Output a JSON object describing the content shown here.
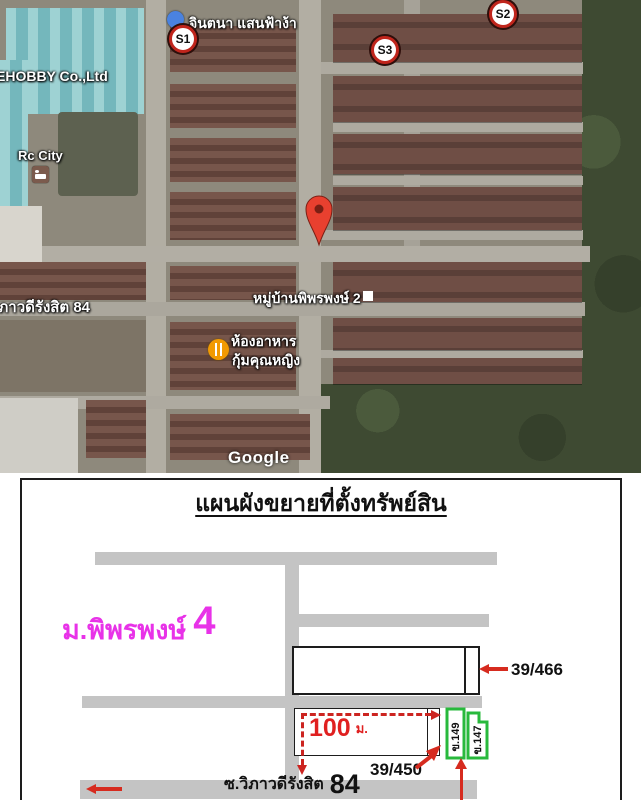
{
  "map": {
    "labels": {
      "place_top": "จินตนา แสนฟ้าง้า",
      "company": "EHOBBY Co.,Ltd",
      "rc_city": "Rc City",
      "village": "หมู่บ้านพิพรพงษ์ 2",
      "restaurant_line1": "ห้องอาหาร",
      "restaurant_line2": "กุ้มคุณหญิง",
      "road": "วิภาวดีรังสิต 84",
      "watermark": "Google"
    },
    "markers": {
      "s1": "S1",
      "s2": "S2",
      "s3": "S3"
    }
  },
  "plan": {
    "title": "แผนผังขยายที่ตั้งทรัพย์สิน",
    "village_label": "ม.พิพรพงษ์",
    "village_number": "4",
    "house_a": "39/466",
    "house_b": "39/450",
    "green_unit_1": "ข.149",
    "green_unit_2": "ข.147",
    "distance_value": "100",
    "distance_unit": "ม.",
    "road_label": "ซ.วิภาวดีรังสิต",
    "road_number": "84"
  },
  "colors": {
    "village_magenta": "#e832e8",
    "arrow_red": "#d62b1f",
    "highlight_green": "#28b93c",
    "road_gray": "#c4c4c4"
  }
}
